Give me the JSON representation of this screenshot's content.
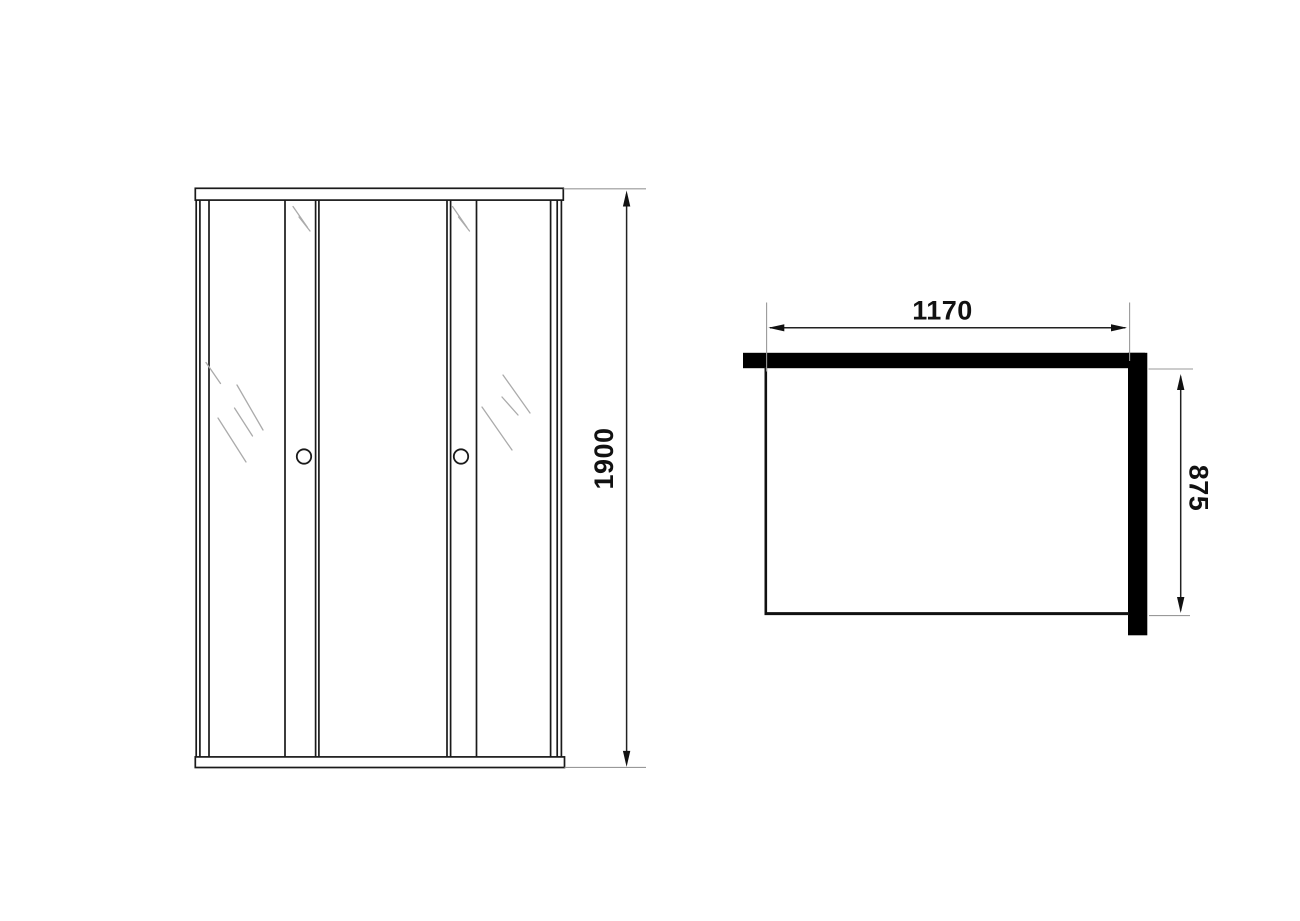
{
  "front_view": {
    "height_label": "1900"
  },
  "top_view": {
    "width_label": "1170",
    "depth_label": "875"
  },
  "colors": {
    "line": "#1a1a1a",
    "extension_line": "#999999",
    "glass_mark": "#ababab",
    "wall_fill": "#000000",
    "background": "#ffffff"
  }
}
